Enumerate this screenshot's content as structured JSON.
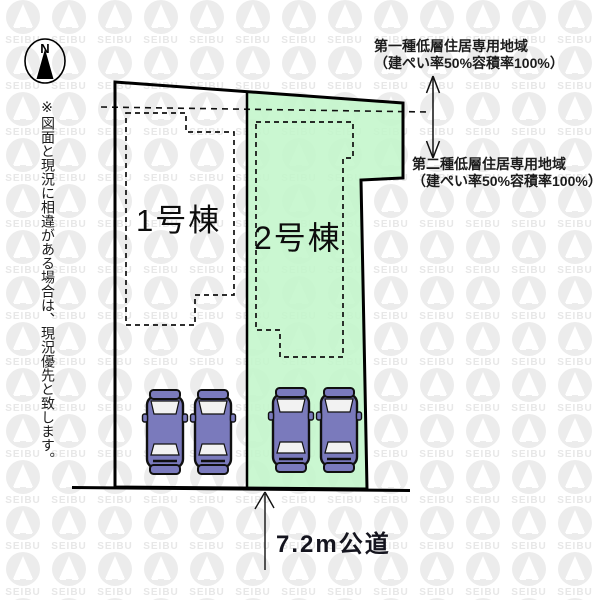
{
  "watermark": {
    "text": "SEIBU",
    "color": "#ececec"
  },
  "compass": {
    "label": "N"
  },
  "disclaimer": "※図面と現況に相違がある場合は、現況優先と致します。",
  "lots": [
    {
      "label": "1号棟",
      "fill": "#ffffff"
    },
    {
      "label": "2号棟",
      "fill": "#c3f6cb"
    }
  ],
  "zoning_labels": [
    {
      "name": "第一種低層住居専用地域",
      "detail": "（建ぺい率50%容積率100%）"
    },
    {
      "name": "第二種低層住居専用地域",
      "detail": "（建ぺい率50%容積率100%）"
    }
  ],
  "road": {
    "label": "7.2m公道"
  },
  "parking": {
    "car_count": 4,
    "car_color": "#7a7abc"
  }
}
